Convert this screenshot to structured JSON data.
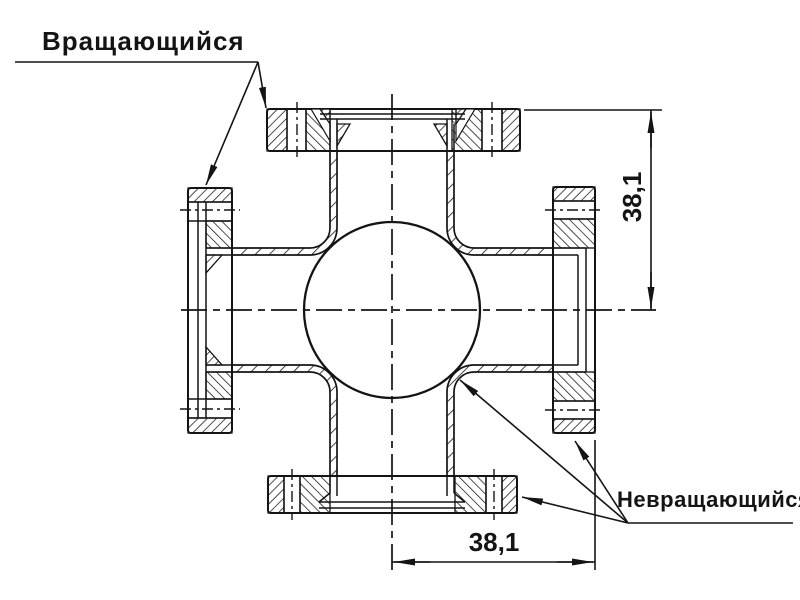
{
  "colors": {
    "ink": "#141414",
    "paper": "#ffffff"
  },
  "callouts": {
    "rotating": "Вращающийся",
    "non_rotating": "Невращающийся"
  },
  "dimensions": {
    "vertical": "38,1",
    "horizontal": "38,1"
  }
}
